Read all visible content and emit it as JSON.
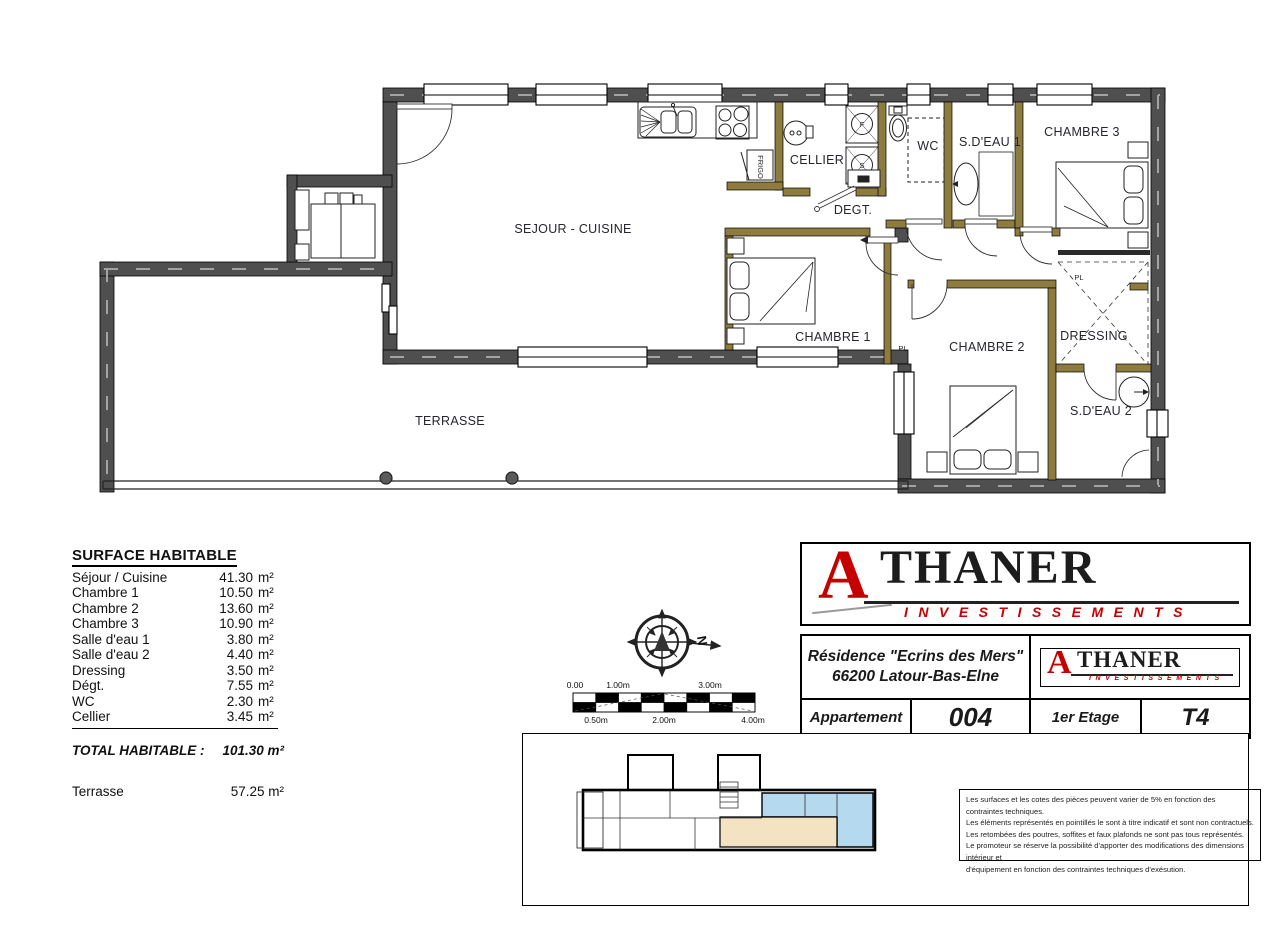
{
  "colors": {
    "wall_dark": "#4f4f4f",
    "wall_olive": "#8d7c3e",
    "brand_red": "#c40000",
    "keyplan_blue": "#b5d9ee",
    "keyplan_tan": "#f3e3c3"
  },
  "brand": {
    "initial": "A",
    "rest": "THANER",
    "subtitle": "INVESTISSEMENTS"
  },
  "floor_plan": {
    "rooms": [
      {
        "id": "sejour-cuisine",
        "label": "SEJOUR - CUISINE"
      },
      {
        "id": "cellier",
        "label": "CELLIER"
      },
      {
        "id": "wc",
        "label": "WC"
      },
      {
        "id": "sdeau1",
        "label": "S.D'EAU 1"
      },
      {
        "id": "chambre3",
        "label": "CHAMBRE 3"
      },
      {
        "id": "degt",
        "label": "DEGT."
      },
      {
        "id": "chambre1",
        "label": "CHAMBRE 1"
      },
      {
        "id": "chambre2",
        "label": "CHAMBRE 2"
      },
      {
        "id": "dressing",
        "label": "DRESSING"
      },
      {
        "id": "sdeau2",
        "label": "S.D'EAU 2"
      },
      {
        "id": "terrasse",
        "label": "TERRASSE"
      }
    ],
    "fixtures": {
      "fridge": "FRIGO",
      "washer_top": "F",
      "washer_bottom": "S",
      "closet_chambre1": "PL",
      "closet_dressing": "PL"
    }
  },
  "compass": {
    "north": "N"
  },
  "scale_bar": {
    "above": [
      "0.00",
      "1.00m",
      "3.00m"
    ],
    "below": [
      "0.50m",
      "2.00m",
      "4.00m"
    ]
  },
  "surface_table": {
    "title": "SURFACE HABITABLE",
    "unit": "m²",
    "rows": [
      {
        "label": "Séjour / Cuisine",
        "value": "41.30"
      },
      {
        "label": "Chambre 1",
        "value": "10.50"
      },
      {
        "label": "Chambre 2",
        "value": "13.60"
      },
      {
        "label": "Chambre 3",
        "value": "10.90"
      },
      {
        "label": "Salle d'eau 1",
        "value": "3.80"
      },
      {
        "label": "Salle d'eau 2",
        "value": "4.40"
      },
      {
        "label": "Dressing",
        "value": "3.50"
      },
      {
        "label": "Dégt.",
        "value": "7.55"
      },
      {
        "label": "WC",
        "value": "2.30"
      },
      {
        "label": "Cellier",
        "value": "3.45"
      }
    ],
    "total_label": "TOTAL HABITABLE :",
    "total_value": "101.30 m²",
    "terrace_label": "Terrasse",
    "terrace_value": "57.25 m²"
  },
  "title_block": {
    "residence_line1": "Résidence \"Ecrins des Mers\"",
    "residence_line2": "66200 Latour-Bas-Elne",
    "apartment_label": "Appartement",
    "apartment_number": "004",
    "floor_label": "1er Etage",
    "unit_type": "T4"
  },
  "disclaimer": {
    "lines": [
      "Les surfaces et les cotes des pièces peuvent varier de 5% en fonction des contraintes techniques.",
      "Les éléments représentés en pointillés le sont à titre indicatif et sont non contractuels.",
      "Les retombées des poutres, soffites et faux plafonds ne sont pas tous représentés.",
      "Le promoteur se réserve la possibilité d'apporter des modifications des dimensions intérieur et",
      "d'équipement en fonction des contraintes techniques d'exésution."
    ]
  }
}
